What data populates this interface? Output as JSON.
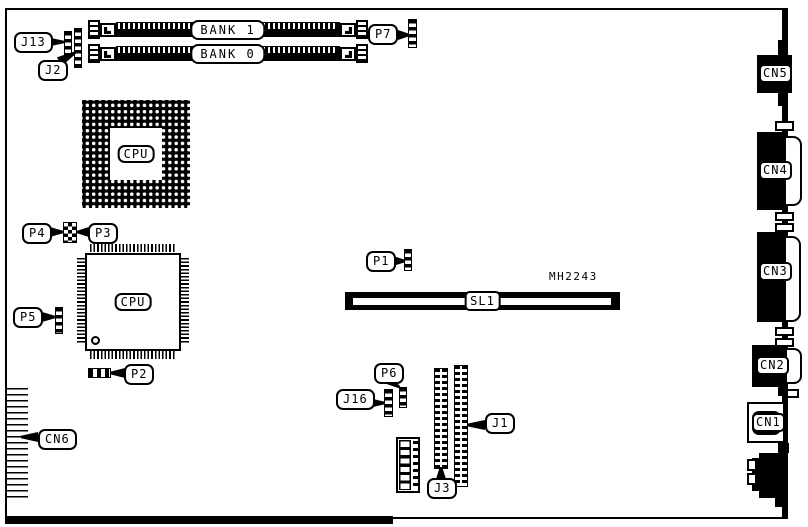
{
  "diagram": {
    "description": "Motherboard component location diagram",
    "part_text": "MH2243",
    "colors": {
      "ink": "#000000",
      "paper": "#ffffff"
    },
    "memory_banks": {
      "bank1": "BANK 1",
      "bank0": "BANK 0"
    },
    "chips": {
      "cpu_pga": "CPU",
      "cpu_qfp": "CPU"
    },
    "slot": {
      "sl1": "SL1"
    },
    "callouts": {
      "j13": "J13",
      "j2": "J2",
      "p7": "P7",
      "p4": "P4",
      "p3": "P3",
      "p5": "P5",
      "p2": "P2",
      "p1": "P1",
      "cn6": "CN6",
      "p6": "P6",
      "j16": "J16",
      "j3": "J3",
      "j1": "J1"
    },
    "rear_connectors": {
      "cn5": "CN5",
      "cn4": "CN4",
      "cn3": "CN3",
      "cn2": "CN2",
      "cn1": "CN1"
    }
  }
}
